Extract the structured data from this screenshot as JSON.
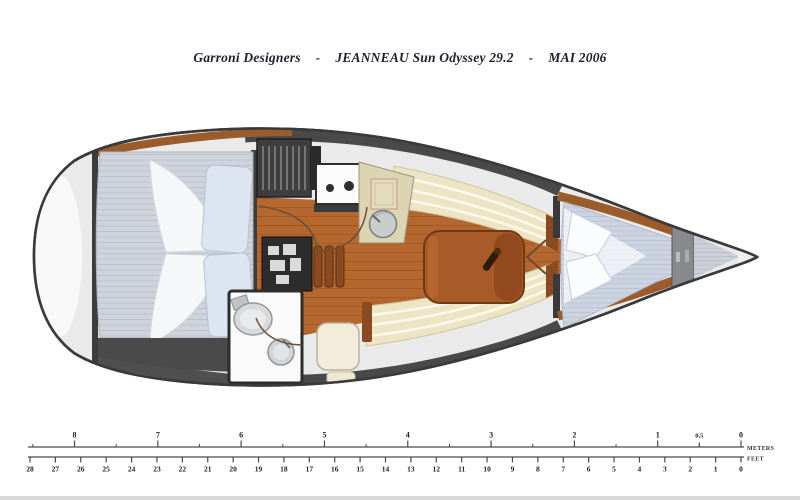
{
  "title": {
    "designer": "Garroni Designers",
    "separator": "-",
    "model": "JEANNEAU Sun Odyssey 29.2",
    "date": "MAI 2006"
  },
  "rulers": {
    "meters": {
      "unit": "METERS",
      "ticks": [
        {
          "label": "8",
          "value": 8
        },
        {
          "label": "7",
          "value": 7
        },
        {
          "label": "6",
          "value": 6
        },
        {
          "label": "5",
          "value": 5
        },
        {
          "label": "4",
          "value": 4
        },
        {
          "label": "3",
          "value": 3
        },
        {
          "label": "2",
          "value": 2
        },
        {
          "label": "1",
          "value": 1
        },
        {
          "label": "0,5",
          "value": 0.5
        },
        {
          "label": "0",
          "value": 0
        }
      ]
    },
    "feet": {
      "unit": "FEET",
      "ticks": [
        {
          "label": "28",
          "value": 28
        },
        {
          "label": "27",
          "value": 27
        },
        {
          "label": "26",
          "value": 26
        },
        {
          "label": "25",
          "value": 25
        },
        {
          "label": "24",
          "value": 24
        },
        {
          "label": "23",
          "value": 23
        },
        {
          "label": "22",
          "value": 22
        },
        {
          "label": "21",
          "value": 21
        },
        {
          "label": "20",
          "value": 20
        },
        {
          "label": "19",
          "value": 19
        },
        {
          "label": "18",
          "value": 18
        },
        {
          "label": "17",
          "value": 17
        },
        {
          "label": "16",
          "value": 16
        },
        {
          "label": "15",
          "value": 15
        },
        {
          "label": "14",
          "value": 14
        },
        {
          "label": "13",
          "value": 13
        },
        {
          "label": "12",
          "value": 12
        },
        {
          "label": "11",
          "value": 11
        },
        {
          "label": "10",
          "value": 10
        },
        {
          "label": "9",
          "value": 9
        },
        {
          "label": "8",
          "value": 8
        },
        {
          "label": "7",
          "value": 7
        },
        {
          "label": "6",
          "value": 6
        },
        {
          "label": "5",
          "value": 5
        },
        {
          "label": "4",
          "value": 4
        },
        {
          "label": "3",
          "value": 3
        },
        {
          "label": "2",
          "value": 2
        },
        {
          "label": "1",
          "value": 1
        },
        {
          "label": "0",
          "value": 0
        }
      ]
    }
  },
  "colors": {
    "hull_stroke": "#3a3a3a",
    "deck_gray": "#eaeaea",
    "dark_module": "#3e3e3e",
    "wood_trim": "#9b5c2c",
    "wood_floor": "#b4672e",
    "table_wood": "#a85a28",
    "settee_cream": "#ece4c2",
    "mattress_gray_blue": "#cfd4dc",
    "pillow_blue": "#dde5f1",
    "title_ink": "#1f1f30"
  }
}
